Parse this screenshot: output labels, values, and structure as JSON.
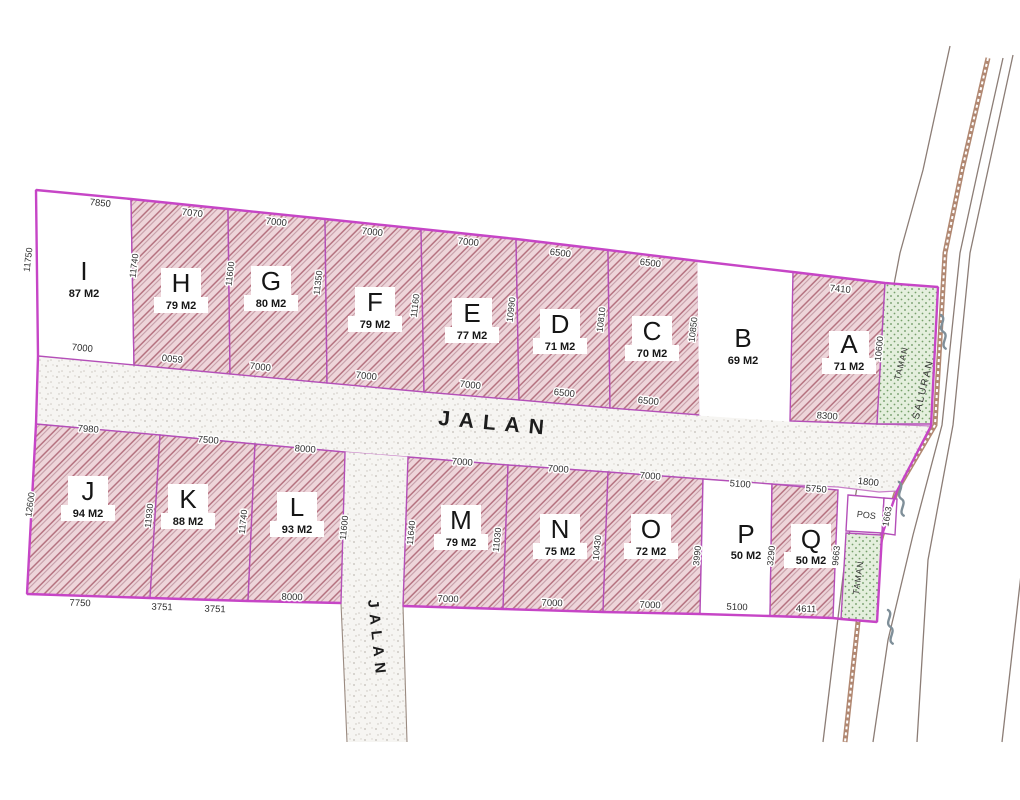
{
  "diagram": {
    "road_horizontal": "JALAN",
    "road_vertical": "JALAN",
    "saluran_label": "SALURAN",
    "taman_top_label": "TAMAN",
    "taman_bottom_label": "TAMAN",
    "pos_label": "POS",
    "strip_dims": {
      "top_right": "1800",
      "pos_right": "1663",
      "q_right": "9663"
    },
    "colors": {
      "boundary_magenta": "#c645c6",
      "hatch_line": "#b4717f",
      "hatch_bg": "#eed5da",
      "taman_green": "#66935c",
      "channel_brown": "#a97b63",
      "road_line": "#8c7d76"
    }
  },
  "plots": {
    "top": [
      {
        "letter": "I",
        "area": "87 M2",
        "dim_top": "7850",
        "dim_bottom": "7000",
        "dim_left": "11750",
        "dim_right": "11740",
        "filled": false
      },
      {
        "letter": "H",
        "area": "79 M2",
        "dim_top": "7070",
        "dim_bottom": "0059",
        "dim_right": "11600",
        "filled": true
      },
      {
        "letter": "G",
        "area": "80 M2",
        "dim_top": "7000",
        "dim_bottom": "7000",
        "dim_right": "11350",
        "filled": true
      },
      {
        "letter": "F",
        "area": "79 M2",
        "dim_top": "7000",
        "dim_bottom": "7000",
        "dim_right": "11160",
        "filled": true
      },
      {
        "letter": "E",
        "area": "77 M2",
        "dim_top": "7000",
        "dim_bottom": "7000",
        "dim_right": "10990",
        "filled": true
      },
      {
        "letter": "D",
        "area": "71 M2",
        "dim_top": "6500",
        "dim_bottom": "6500",
        "dim_right": "10810",
        "filled": true
      },
      {
        "letter": "C",
        "area": "70 M2",
        "dim_top": "6500",
        "dim_bottom": "6500",
        "dim_right": "10850",
        "filled": true
      },
      {
        "letter": "B",
        "area": "69 M2",
        "filled": false
      },
      {
        "letter": "A",
        "area": "71 M2",
        "dim_top": "7410",
        "dim_bottom": "8300",
        "dim_right": "10600",
        "filled": true
      }
    ],
    "bottom": [
      {
        "letter": "J",
        "area": "94 M2",
        "dim_top": "7980",
        "dim_bottom": "7750",
        "dim_left": "12600",
        "dim_right": "11930",
        "filled": true
      },
      {
        "letter": "K",
        "area": "88 M2",
        "dim_top": "7500",
        "dim_bottom_a": "3751",
        "dim_bottom_b": "3751",
        "dim_right": "11740",
        "filled": true
      },
      {
        "letter": "L",
        "area": "93 M2",
        "dim_top": "8000",
        "dim_bottom": "8000",
        "dim_right": "11600",
        "filled": true
      },
      {
        "letter": "M",
        "area": "79 M2",
        "dim_top": "7000",
        "dim_bottom": "7000",
        "dim_left": "11640",
        "dim_right": "11030",
        "filled": true
      },
      {
        "letter": "N",
        "area": "75 M2",
        "dim_top": "7000",
        "dim_bottom": "7000",
        "dim_right": "10430",
        "filled": true
      },
      {
        "letter": "O",
        "area": "72 M2",
        "dim_top": "7000",
        "dim_bottom": "7000",
        "dim_right": "3990",
        "filled": true
      },
      {
        "letter": "P",
        "area": "50 M2",
        "dim_top": "5100",
        "dim_bottom": "5100",
        "dim_right": "3290",
        "filled": false
      },
      {
        "letter": "Q",
        "area": "50 M2",
        "dim_top": "5750",
        "dim_bottom": "4611",
        "filled": true
      }
    ]
  }
}
